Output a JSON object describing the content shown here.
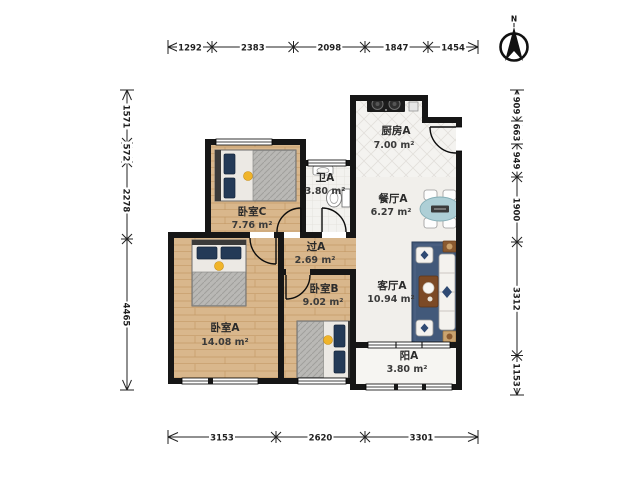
{
  "title": "三室户型图",
  "compass": {
    "label": "N"
  },
  "dimensions": {
    "top": [
      "1292",
      "2383",
      "2098",
      "1847",
      "1454"
    ],
    "bottom": [
      "3153",
      "2620",
      "3301"
    ],
    "left": [
      "1571",
      "572",
      "2278",
      "4465"
    ],
    "right": [
      "909",
      "663",
      "949",
      "1900",
      "3312",
      "1153"
    ]
  },
  "rooms": [
    {
      "id": "bedroom-c",
      "name": "卧室C",
      "area": "7.76 m²"
    },
    {
      "id": "bath-a",
      "name": "卫A",
      "area": "3.80 m²"
    },
    {
      "id": "kitchen-a",
      "name": "厨房A",
      "area": "7.00 m²"
    },
    {
      "id": "dining-a",
      "name": "餐厅A",
      "area": "6.27 m²"
    },
    {
      "id": "hall-a",
      "name": "过A",
      "area": "2.69 m²"
    },
    {
      "id": "bedroom-b",
      "name": "卧室B",
      "area": "9.02 m²"
    },
    {
      "id": "living-a",
      "name": "客厅A",
      "area": "10.94 m²"
    },
    {
      "id": "bedroom-a",
      "name": "卧室A",
      "area": "14.08 m²"
    },
    {
      "id": "balcony-a",
      "name": "阳A",
      "area": "3.80 m²"
    }
  ],
  "colors": {
    "wall": "#161616",
    "wood_floor": "#d9b78c",
    "rug": "#42597a",
    "dining_table": "#aecfd6",
    "accent_navy": "#2f4a73",
    "accent_yellow": "#f0b429"
  }
}
